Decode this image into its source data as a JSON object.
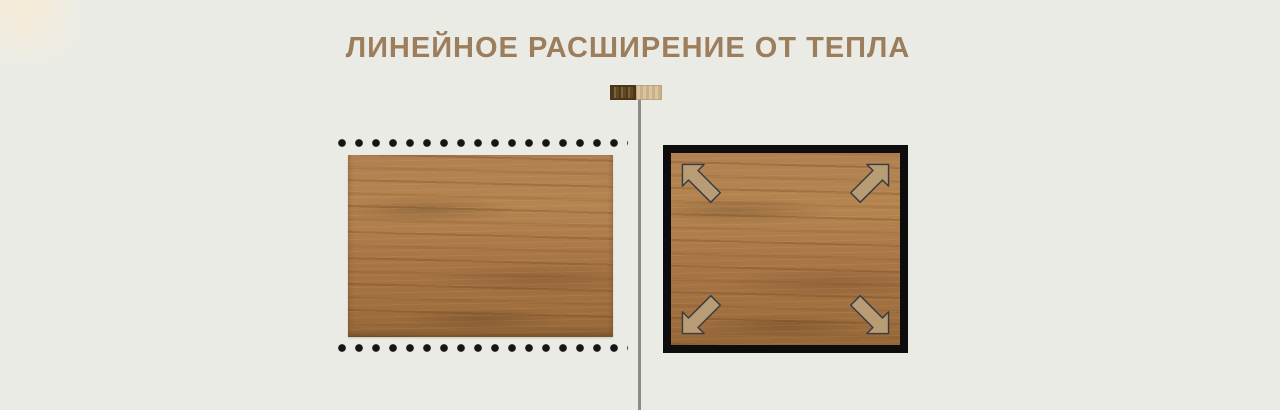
{
  "header": {
    "title": "ЛИНЕЙНОЕ РАСШИРЕНИЕ ОТ ТЕПЛА"
  },
  "colors": {
    "background": "#ebebe6",
    "title": "#9c7e5d",
    "divider": "#8c8c86",
    "dots": "#151515",
    "frame": "#0d0d0d",
    "arrow_fill": "#b89c74",
    "arrow_outline": "#3a3a44",
    "wood_base_left": "#aa7a49",
    "wood_base_right": "#b5814e",
    "swatch_dark": "#6e5126",
    "swatch_light": "#d2b88f"
  },
  "legend": {
    "dark_swatch_icon": "dark-wood-swatch",
    "light_swatch_icon": "light-wood-swatch"
  },
  "figures": {
    "left": {
      "icon": "wood-panel-with-dotted-guides",
      "dots_rows": 2
    },
    "right": {
      "icon": "wood-panel-in-black-frame",
      "arrow_icon": "diagonal-expansion-arrow",
      "arrow_count": 4
    }
  }
}
